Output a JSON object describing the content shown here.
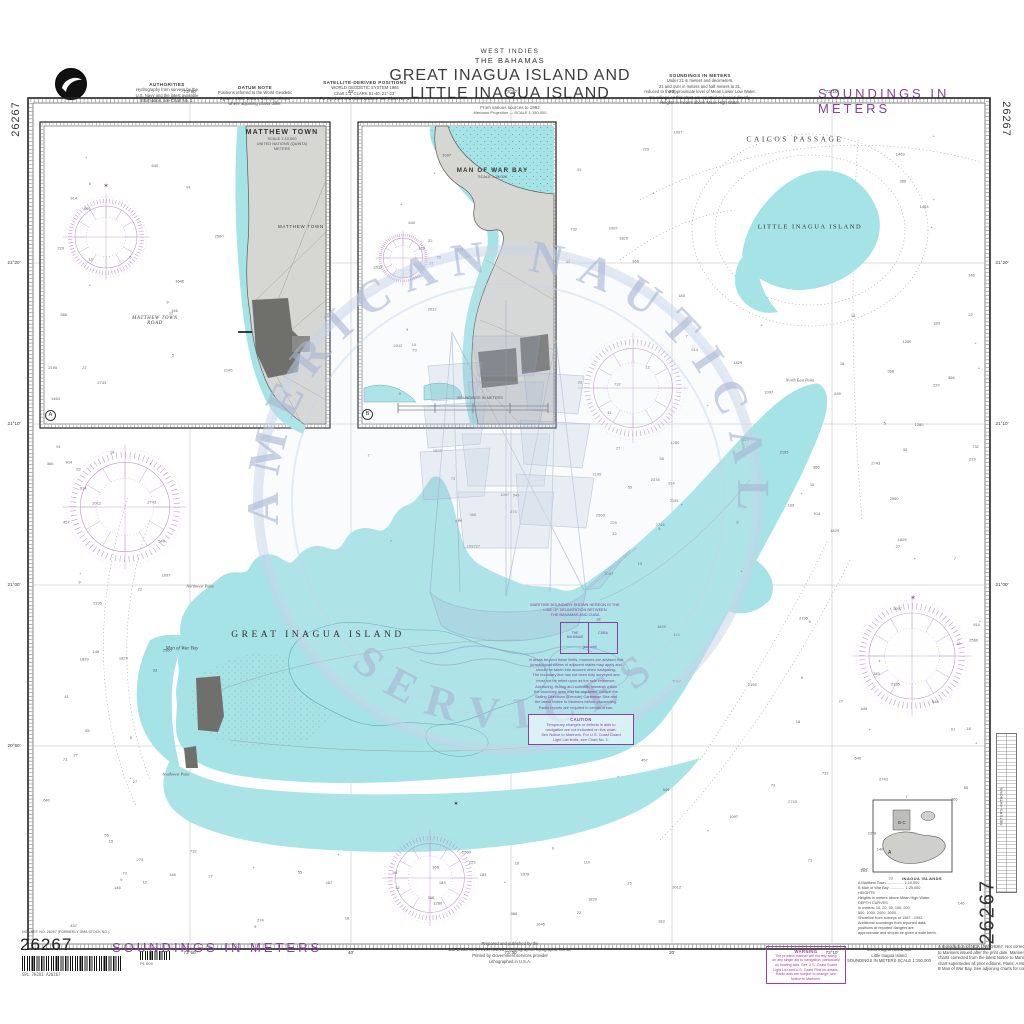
{
  "colors": {
    "purple": "#8b3fa0",
    "magenta": "#a83aa0",
    "cyan": "#a6e3e6",
    "land": "#d6d6d3",
    "town": "#6f6f6c",
    "watermark": "#a9b7d3"
  },
  "margin": {
    "chart_number": "26267",
    "soundings_top": "SOUNDINGS IN METERS",
    "soundings_bottom": "SOUNDINGS IN METERS",
    "stock_line": "NGA REF. NO. 26267 (FORMERLY DMA STOCK NO.)",
    "barcode_caption": "GPL 7H2O1 A26267",
    "barcode_caption2": "P1 009"
  },
  "header": {
    "region": "WEST INDIES",
    "subregion": "THE BAHAMAS",
    "title1": "GREAT INAGUA ISLAND AND",
    "title2": "LITTLE INAGUA ISLAND",
    "source": "From various sources to 1992",
    "scale": "Mercator Projection — SCALE 1:150,000"
  },
  "top_notes": [
    {
      "title": "AUTHORITIES",
      "lines": [
        "Hydrography from surveys by the",
        "U.S. Navy and the latest available",
        "information, see Chart No. 1."
      ]
    },
    {
      "title": "DATUM NOTE",
      "lines": [
        "Positions referred to the World Geodetic",
        "System 1984. Datum shifts are shown",
        "where adjoining charts differ."
      ]
    },
    {
      "title": "SATELLITE-DERIVED POSITIONS",
      "lines": [
        "WORLD GEODETIC SYSTEM 1984",
        "Chart 1:1, CLARK 81-40, 21°-23°",
        "For Symbols and Abbreviations, see Chart No. 1."
      ]
    },
    {
      "title": "SOUNDINGS IN METERS",
      "lines": [
        "Under 21 in meters and decimeters,",
        "21 and over in meters and half meters to 31,",
        "reduced to the approximate level of Mean Lower Low Water.",
        "Soundings on this chart are reported or leased directly.",
        "Heights in meters above Mean High Water."
      ]
    }
  ],
  "watermark": {
    "arc_top": "AMERICAN NAUTICAL",
    "arc_bottom": "SERVICES"
  },
  "map_labels": [
    {
      "text": "CAICOS PASSAGE",
      "x": 795,
      "y": 139,
      "cls": "lbl-passage"
    },
    {
      "text": "LITTLE INAGUA ISLAND",
      "x": 810,
      "y": 227,
      "cls": "lbl-island2"
    },
    {
      "text": "GREAT INAGUA ISLAND",
      "x": 318,
      "y": 635,
      "cls": "lbl-island1"
    },
    {
      "text": "Man of War Bay",
      "x": 182,
      "y": 649,
      "cls": "lbl-bay"
    },
    {
      "text": "Northwest Point",
      "x": 200,
      "y": 586,
      "cls": "lbl-pt"
    },
    {
      "text": "North East Point",
      "x": 800,
      "y": 380,
      "cls": "lbl-pt"
    },
    {
      "text": "Southwest Point",
      "x": 176,
      "y": 774,
      "cls": "lbl-pt"
    },
    {
      "text": "✶",
      "x": 913,
      "y": 598,
      "cls": "lbl-star"
    },
    {
      "text": "✶",
      "x": 106,
      "y": 186,
      "cls": "lbl-star"
    },
    {
      "text": "✶",
      "x": 456,
      "y": 804,
      "cls": "lbl-star-k"
    }
  ],
  "insets": {
    "a": {
      "title": "MATTHEW TOWN",
      "sub1": "SCALE 1:10,000",
      "sub2": "UNITED NATIONS (QUINTA)",
      "sub3": "METERS",
      "land_label": "MATTHEW TOWN",
      "road1": "MATTHEW TOWN",
      "road2": "ROAD",
      "badge": "A"
    },
    "b": {
      "title": "MAN OF WAR BAY",
      "sub1": "SCALE 1:25,000",
      "scale_caption": "SOUNDINGS IN METERS",
      "badge": "B"
    }
  },
  "center_notes": {
    "heading": [
      "MARITIME BOUNDARY SHOWN HEREON IS THE",
      "LINE OF DELIMITATION BETWEEN",
      "THE BAHAMAS AND CUBA"
    ],
    "diagram_left": "THE BAHAMAS",
    "diagram_right": "CUBA",
    "diagram_note": "(see note)",
    "para1": [
      "In areas beyond these limits, mariners are advised that",
      "jurisdictional claims of adjacent states may apply and",
      "should be taken into account when navigating.",
      "The boundary line has not been fully surveyed and",
      "must not be relied upon as the sole reference."
    ],
    "para2": [
      "Anchoring, fishing and scientific research within",
      "the boundary area may be regulated; consult the",
      "Sailing Directions (Enroute) Caribbean Sea and",
      "the latest Notice to Mariners before proceeding.",
      "Radio reports are required in certain areas."
    ],
    "caution_title": "CAUTION",
    "caution_lines": [
      "Temporary changes or defects in aids to",
      "navigation are not indicated on this chart.",
      "See Notice to Mariners. For U.S. Coast Guard",
      "Light List limits, see Chart No. 1."
    ]
  },
  "plans_box": {
    "title": "INAGUA ISLANDS",
    "lines": [
      "A  Matthew Town ................ 1:10,000",
      "B  Man of War Bay .............. 1:25,000",
      "HEIGHTS",
      "   Heights in meters above Mean High Water.",
      "DEPTH CURVES",
      "   In meters: 10, 20, 50, 100, 200,",
      "   500, 1000, 2000, 3000.",
      "Shoreline from surveys of 1987 - 1992.",
      "Additional soundings from reported data;",
      "positions of reported dangers are",
      "approximate and should be given a wide berth."
    ]
  },
  "bottom": {
    "prepared1": [
      "Prepared and published by the",
      "DEFENSE MAPPING AGENCY, Hydrographic/Topographic Center"
    ],
    "prepared2": [
      "Printed by Government services provider",
      "Lithographed in U.S.A."
    ],
    "warning_title": "WARNING",
    "warning_lines": [
      "The prudent mariner will not rely solely",
      "on any single aid to navigation, particularly",
      "on floating aids. See U.S. Coast Guard",
      "Light List and U.S. Coast Pilot for details.",
      "Radio aids are subject to change; see",
      "Notice to Mariners."
    ],
    "product_lines": [
      "Great Inagua Island and",
      "Little Inagua Island",
      "SOUNDINGS IN METERS   SCALE 1:150,000"
    ],
    "right_note": [
      "A reproduction of NGA chart 26267. Not corrected for Notices",
      "to Mariners issued after the print date. Mariners should keep",
      "charts corrected from the latest Notice to Mariners. This",
      "chart supersedes all prior editions. Plans: A Matthew Town,",
      "B Man of War Bay. See adjoining charts for continuation."
    ]
  },
  "side_table": {
    "caption": "METERS–FATHOMS"
  },
  "graticule": {
    "top": [
      "73°50'",
      "40'",
      "73°30'",
      "20'",
      "73°10'"
    ],
    "bottom": [
      "73°50'",
      "40'",
      "73°30'",
      "20'",
      "73°10'"
    ],
    "left": [
      "21°20'",
      "21°10'",
      "21°00'",
      "20°50'"
    ],
    "right": [
      "21°20'",
      "21°10'",
      "21°00'"
    ]
  },
  "compass_roses": [
    {
      "x": 125,
      "y": 507,
      "r": 52
    },
    {
      "x": 633,
      "y": 388,
      "r": 46
    },
    {
      "x": 912,
      "y": 656,
      "r": 50
    },
    {
      "x": 430,
      "y": 878,
      "r": 40
    },
    {
      "x": 106,
      "y": 237,
      "r": 36
    },
    {
      "x": 403,
      "y": 258,
      "r": 23
    }
  ],
  "soundings": {
    "seed": 42,
    "values": [
      "5",
      "7",
      "9",
      "12",
      "15",
      "18",
      "22",
      "27",
      "33",
      "41",
      "55",
      "73",
      "91",
      "110",
      "146",
      "183",
      "229",
      "274",
      "366",
      "457",
      "549",
      "640",
      "732",
      "914",
      "1097",
      "1280",
      "1463",
      "1646",
      "1829",
      "2012",
      "2195",
      "2378",
      "2560",
      "2743"
    ],
    "zones": [
      {
        "x": 42,
        "y": 440,
        "w": 128,
        "h": 490,
        "n": 38
      },
      {
        "x": 180,
        "y": 845,
        "w": 500,
        "h": 88,
        "n": 30
      },
      {
        "x": 560,
        "y": 120,
        "w": 175,
        "h": 420,
        "n": 30
      },
      {
        "x": 882,
        "y": 120,
        "w": 100,
        "h": 430,
        "n": 22
      },
      {
        "x": 735,
        "y": 305,
        "w": 160,
        "h": 240,
        "n": 16
      },
      {
        "x": 690,
        "y": 560,
        "w": 290,
        "h": 365,
        "n": 40
      },
      {
        "x": 355,
        "y": 440,
        "w": 295,
        "h": 108,
        "n": 14
      },
      {
        "x": 48,
        "y": 150,
        "w": 180,
        "h": 260,
        "n": 22
      },
      {
        "x": 364,
        "y": 132,
        "w": 98,
        "h": 275,
        "n": 16
      },
      {
        "x": 580,
        "y": 560,
        "w": 95,
        "h": 255,
        "n": 10
      }
    ]
  }
}
